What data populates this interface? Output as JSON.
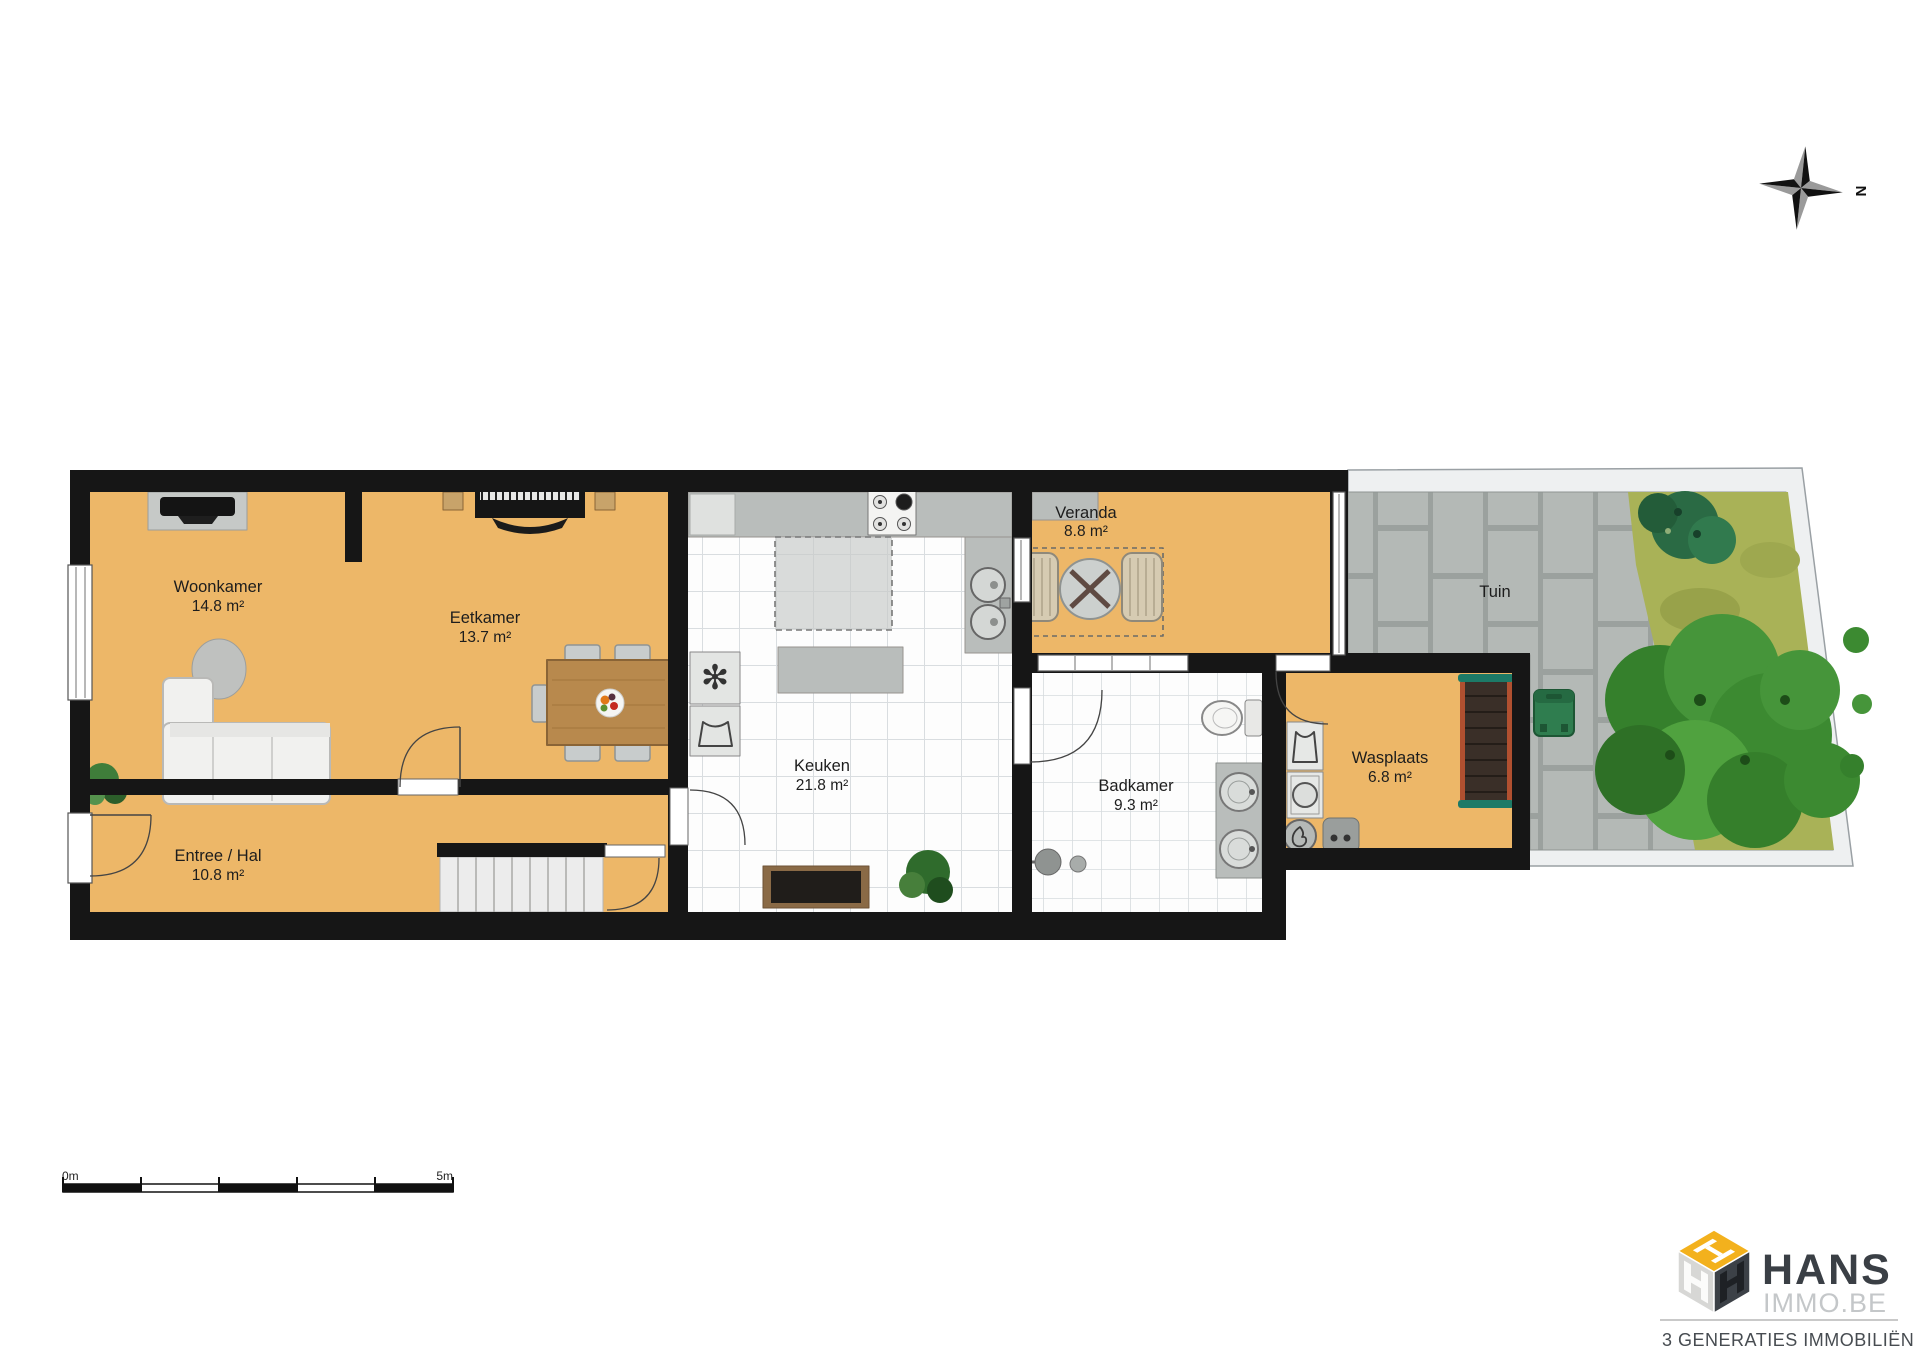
{
  "title": "Gelijkvloers plattegrond",
  "compass": {
    "label": "N"
  },
  "scale_bar": {
    "start_label": "0m",
    "end_label": "5m"
  },
  "rooms": [
    {
      "name": "Woonkamer",
      "area": "14.8 m²"
    },
    {
      "name": "Eetkamer",
      "area": "13.7 m²"
    },
    {
      "name": "Entree / Hal",
      "area": "10.8 m²"
    },
    {
      "name": "Keuken",
      "area": "21.8 m²"
    },
    {
      "name": "Veranda",
      "area": "8.8 m²"
    },
    {
      "name": "Badkamer",
      "area": "9.3 m²"
    },
    {
      "name": "Wasplaats",
      "area": "6.8 m²"
    },
    {
      "name": "Tuin",
      "area": ""
    }
  ],
  "logo": {
    "brand": "HANS",
    "domain": "IMMO.BE",
    "tagline": "3 GENERATIES IMMOBILIËN"
  },
  "colors": {
    "floor_orange": "#edb768",
    "wall_black": "#161616",
    "counter_gray": "#b9bdbb",
    "tile_white": "#fdfdfd",
    "garden_paving": "#b4b9b6",
    "grass_green": "#a9b257",
    "tree_green": "#3f8f34",
    "logo_yellow": "#f3b11d",
    "logo_dark": "#3c4147"
  }
}
